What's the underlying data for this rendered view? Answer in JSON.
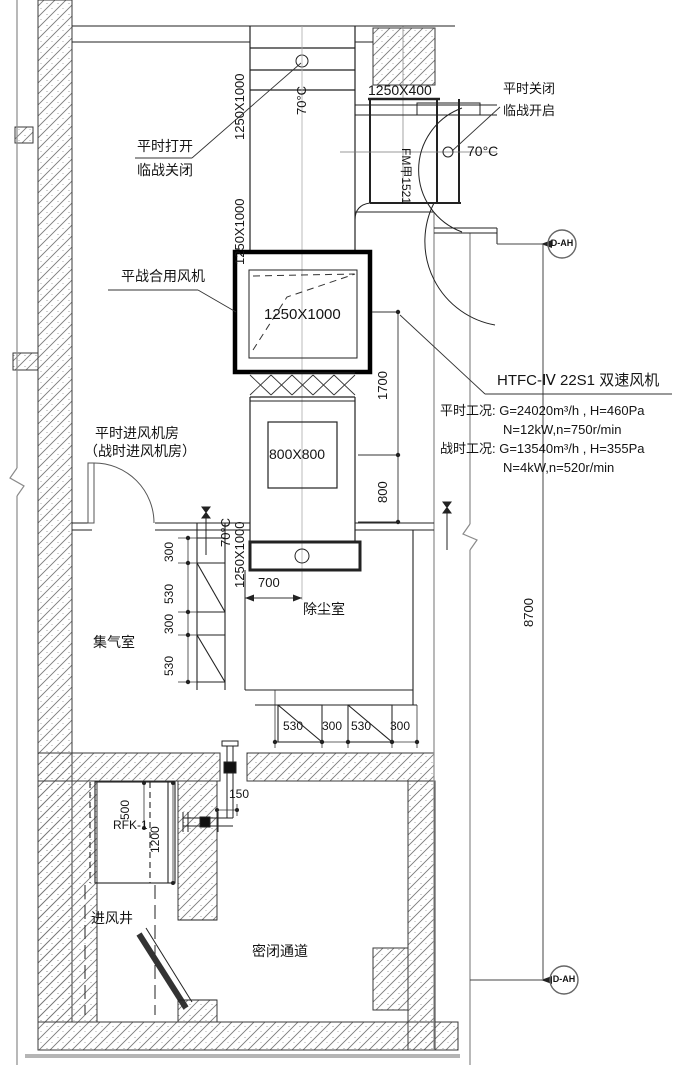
{
  "callouts": {
    "top_left_1": "平时打开",
    "top_left_2": "临战关闭",
    "top_right_1": "平时关闭",
    "top_right_2": "临战开启",
    "fan": "平战合用风机"
  },
  "labels": {
    "riser_top_size": "1250X1000",
    "riser_top_temp": "70°C",
    "branch_size": "1250X400",
    "branch_temp": "70°C",
    "door": "FM甲1521",
    "riser_mid_size": "1250X1000",
    "fan_size": "1250X1000",
    "box_size": "800X800",
    "riser_low_temp": "70°C",
    "riser_low_size": "1250X1000",
    "filter": "RFK-1"
  },
  "rooms": {
    "fan_room_1": "平时进风机房",
    "fan_room_2": "（战时进风机房）",
    "plenum": "集气室",
    "dust": "除尘室",
    "shaft": "进风井",
    "passage": "密闭通道"
  },
  "fan_spec": {
    "model": "HTFC-Ⅳ 22S1 双速风机",
    "normal": "平时工况: G=24020m³/h , H=460Pa",
    "normal_2": "N=12kW,n=750r/min",
    "war": "战时工况: G=13540m³/h , H=355Pa",
    "war_2": "N=4kW,n=520r/min"
  },
  "dims": {
    "v1700": "1700",
    "v800": "800",
    "h700": "700",
    "left_chain": [
      "300",
      "530",
      "300",
      "530"
    ],
    "bottom_chain": [
      "530",
      "300",
      "530",
      "300"
    ],
    "v500": "500",
    "v1200": "1200",
    "h150": "150",
    "v8700": "8700"
  },
  "bubbles": {
    "top": "D-AH",
    "bottom": "D-AH"
  }
}
